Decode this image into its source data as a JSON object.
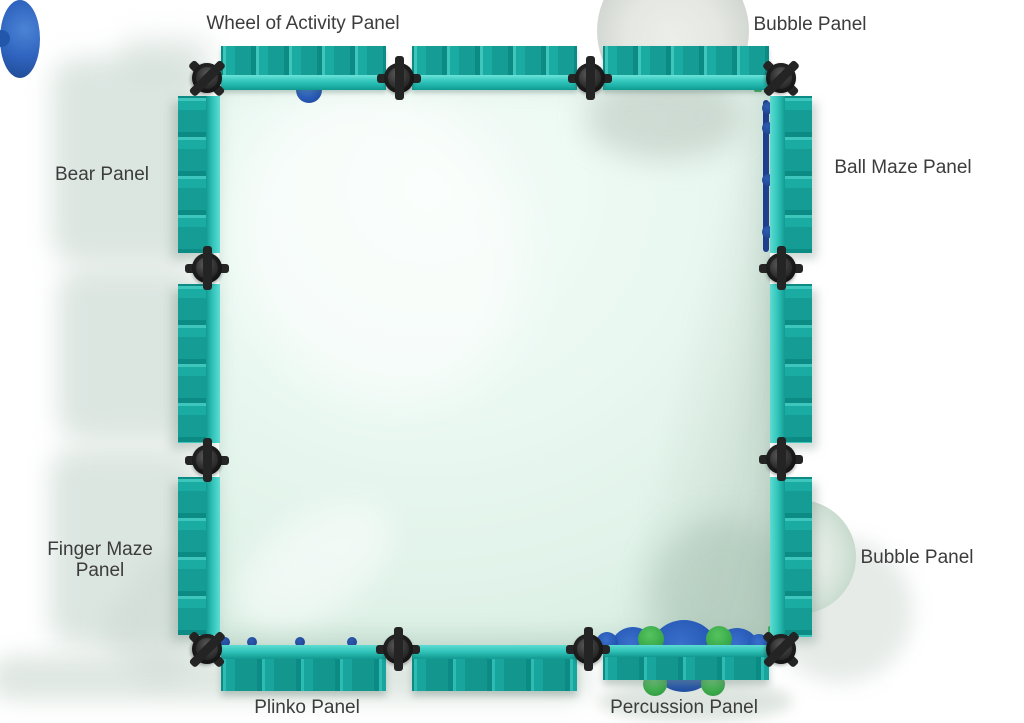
{
  "page": {
    "type": "product-top-view-diagram",
    "background": "#ffffff"
  },
  "labels": {
    "wheel_of_activity": "Wheel of Activity Panel",
    "bubble_top": "Bubble Panel",
    "bear": "Bear Panel",
    "ball_maze": "Ball Maze Panel",
    "finger_maze": "Finger Maze Panel",
    "bubble_right": "Bubble Panel",
    "plinko": "Plinko Panel",
    "percussion": "Percussion Panel"
  },
  "structure": {
    "shape": "square play-panel enclosure viewed from above",
    "panels_per_side": 3,
    "connector_posts": 12,
    "sides": {
      "top": [
        "Wheel of Activity Panel",
        "",
        "Bubble Panel"
      ],
      "right": [
        "Ball Maze Panel",
        "",
        "Bubble Panel"
      ],
      "left": [
        "Bear Panel",
        "",
        "Finger Maze Panel"
      ],
      "bottom": [
        "Plinko Panel",
        "",
        "Percussion Panel"
      ]
    }
  },
  "colors": {
    "panel_teal": "#19aca4",
    "panel_teal_light": "#4ed0c7",
    "panel_teal_dark": "#0e8e88",
    "connector_dark": "#2a2a2a",
    "feature_blue": "#2e63c4",
    "feature_navy": "#1e3f8c",
    "feature_green": "#43b553",
    "interior_mint": "#e9f8f1",
    "dome_gray": "#d6dad4",
    "label_text": "#3c3c3c",
    "background": "#ffffff"
  }
}
